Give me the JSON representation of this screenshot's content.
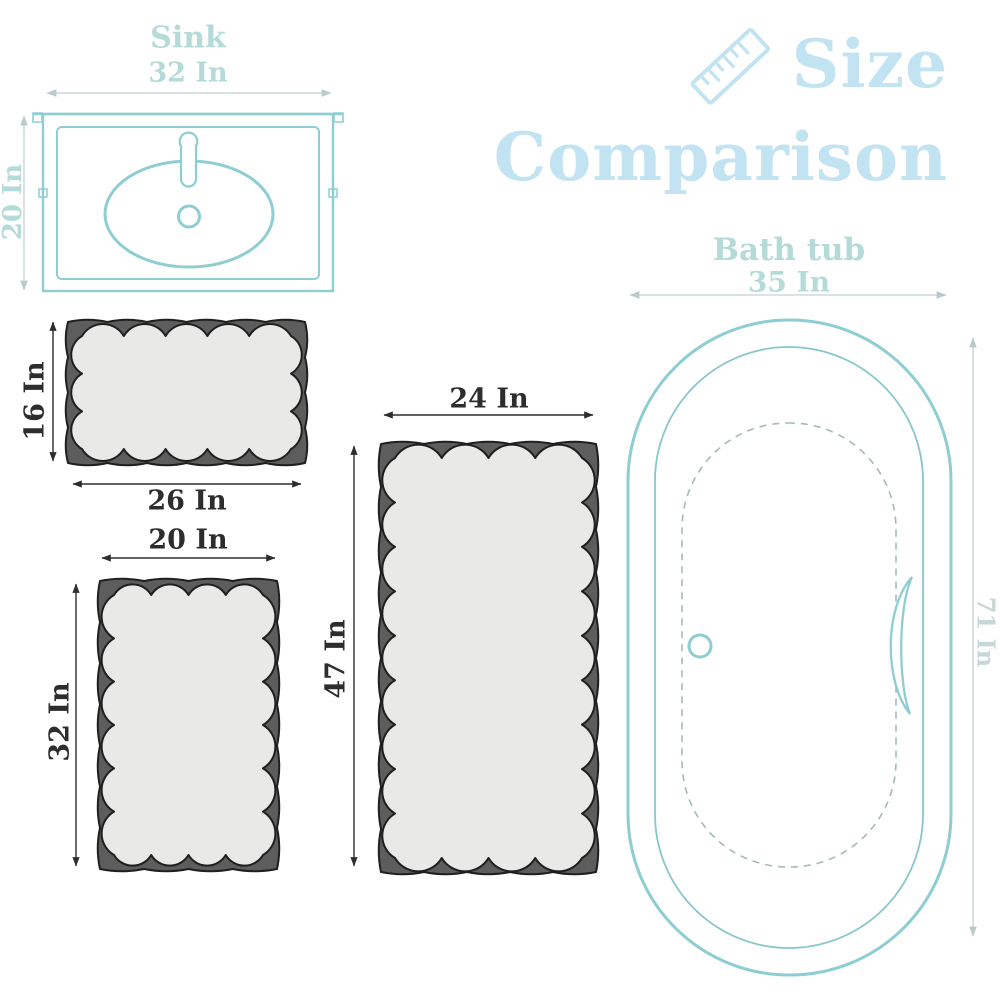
{
  "title": {
    "line1": "Size",
    "line2": "Comparison"
  },
  "sink": {
    "label": "Sink",
    "width": "32 In",
    "height": "20 In"
  },
  "bathtub": {
    "label": "Bath tub",
    "width": "35 In",
    "height": "71 In"
  },
  "rugs": [
    {
      "name": "small rug",
      "width": "26 In",
      "height": "16 In"
    },
    {
      "name": "medium rug",
      "width": "20 In",
      "height": "32 In"
    },
    {
      "name": "runner rug",
      "width": "24 In",
      "height": "47 In"
    }
  ],
  "icons": {
    "ruler": "ruler-icon"
  },
  "colors": {
    "title_blue": "#c2e3f1",
    "fixture_teal": "#8ecdd2",
    "fixture_teal_thin": "#89c6cc",
    "dashed_gray_teal": "#a6b9ba",
    "light_label_teal": "#b5dbd9",
    "faint_label": "#c7d6d6",
    "dim_line_light": "#c3d2d2",
    "dim_line_dark": "#2d2d2d",
    "rug_border": "#5d5d5d",
    "rug_outline": "#1f1f1f",
    "rug_fill": "#e9e9e8",
    "background": "#ffffff"
  }
}
